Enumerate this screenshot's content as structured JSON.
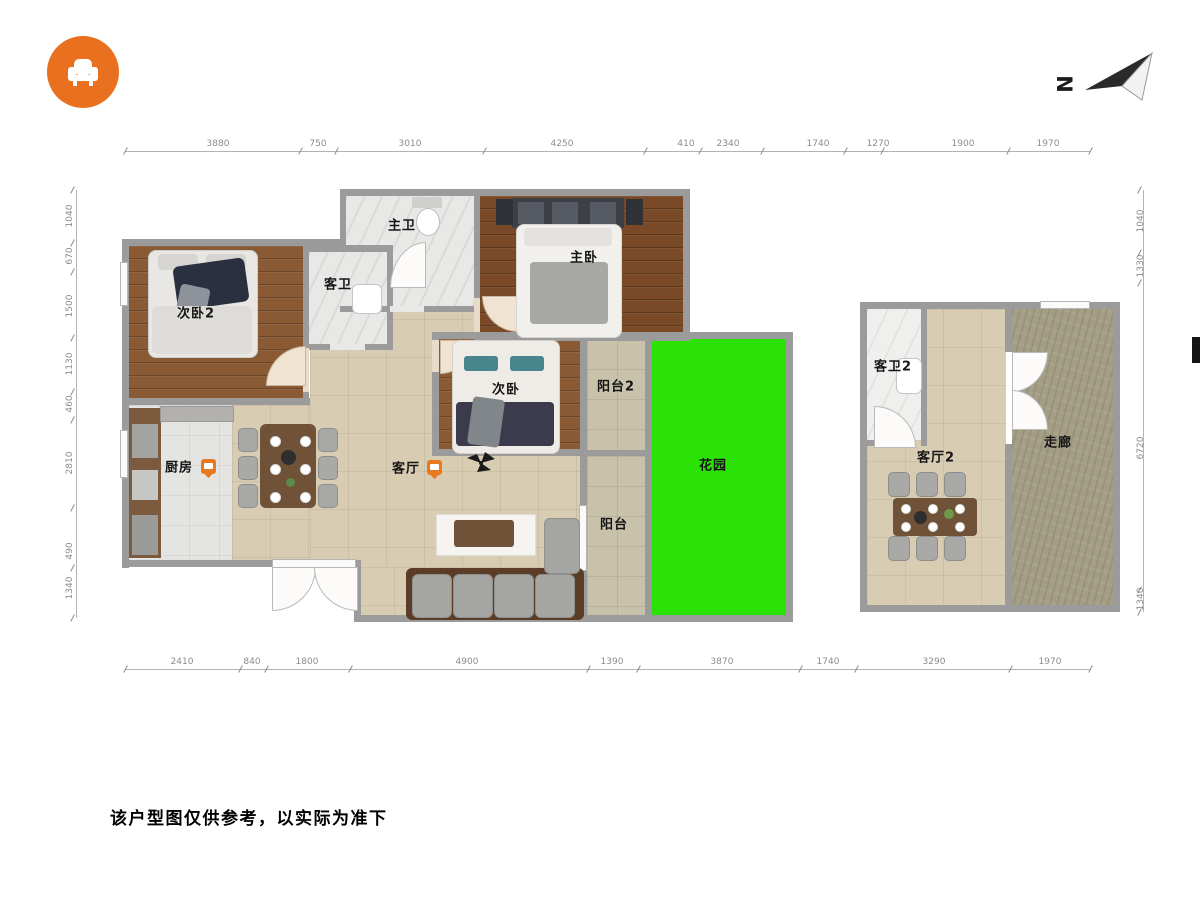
{
  "app": {
    "disclaimer": "该户型图仅供参考，以实际为准下"
  },
  "compass": {
    "label": "N"
  },
  "rooms": {
    "master_bath": "主卫",
    "guest_bath": "客卫",
    "master_bedroom": "主卧",
    "bedroom2": "次卧2",
    "bedroom3": "次卧",
    "balcony2": "阳台2",
    "garden": "花园",
    "kitchen": "厨房",
    "living_room": "客厅",
    "balcony": "阳台",
    "guest_bath2": "客卫2",
    "living_room2": "客厅2",
    "corridor": "走廊"
  },
  "dimensions": {
    "top": [
      "3880",
      "750",
      "3010",
      "4250",
      "410",
      "2340",
      "1740",
      "1270",
      "1900",
      "1970"
    ],
    "bottom": [
      "2410",
      "840",
      "1800",
      "4900",
      "1390",
      "3870",
      "1740",
      "3290",
      "1970"
    ],
    "left": [
      "1040",
      "670",
      "1500",
      "1130",
      "460",
      "2810",
      "490",
      "1340"
    ],
    "right": [
      "1040",
      "1330",
      "6720",
      "1340"
    ]
  },
  "colors": {
    "logo_orange": "#E8701E",
    "marker_orange": "#E8791E",
    "garden_green": "#2BE206",
    "wall_gray": "#9B9B9B"
  }
}
